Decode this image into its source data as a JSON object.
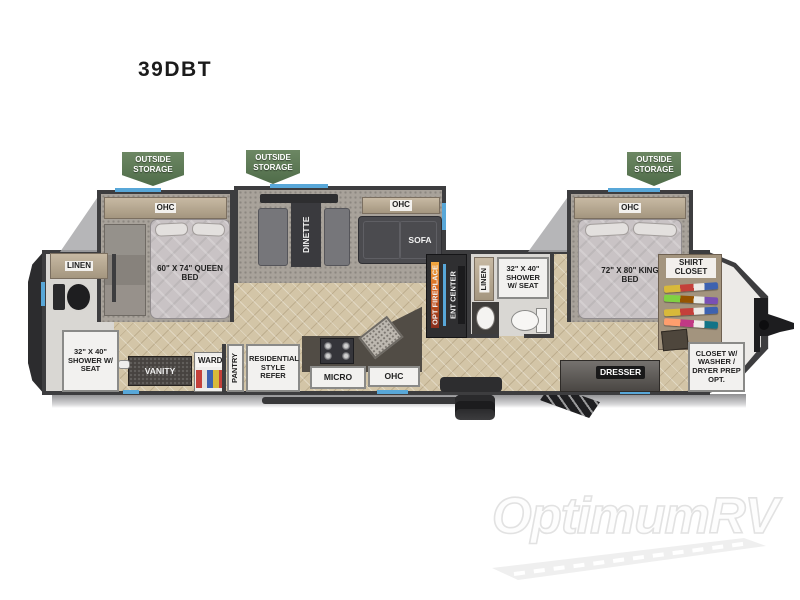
{
  "page": {
    "model": "39DBT",
    "watermark": "OptimumRV"
  },
  "colors": {
    "storage_tag_green": "#5d7c54",
    "window_blue": "#58a7d8",
    "wall_dark": "#3d3d3f",
    "floor_tan": "#d3c5a7"
  },
  "tags": {
    "storage_rear": "OUTSIDE STORAGE",
    "storage_mid": "OUTSIDE STORAGE",
    "storage_front": "OUTSIDE STORAGE"
  },
  "rear_bath": {
    "linen": "LINEN",
    "shower": "32\" X 40\" SHOWER W/ SEAT"
  },
  "rear_bedroom": {
    "ohc": "OHC",
    "bed": "60\" X 74\" QUEEN BED",
    "vanity": "VANITY",
    "ward": "WARD"
  },
  "kitchen": {
    "pantry": "PANTRY",
    "refer": "RESIDENTIAL STYLE REFER",
    "micro": "MICRO",
    "ohc": "OHC"
  },
  "living": {
    "dinette": "DINETTE",
    "sofa_ohc": "OHC",
    "sofa": "SOFA",
    "opt_fireplace": "OPT FIREPLACE",
    "ent_center": "ENT CENTER"
  },
  "mid_bath": {
    "linen": "LINEN",
    "shower": "32\" X 40\" SHOWER W/ SEAT"
  },
  "front_bedroom": {
    "ohc": "OHC",
    "bed": "72\" X 80\" KING BED",
    "shirt_closet": "SHIRT CLOSET",
    "dresser": "DRESSER",
    "wd_closet": "CLOSET W/ WASHER / DRYER PREP OPT."
  }
}
